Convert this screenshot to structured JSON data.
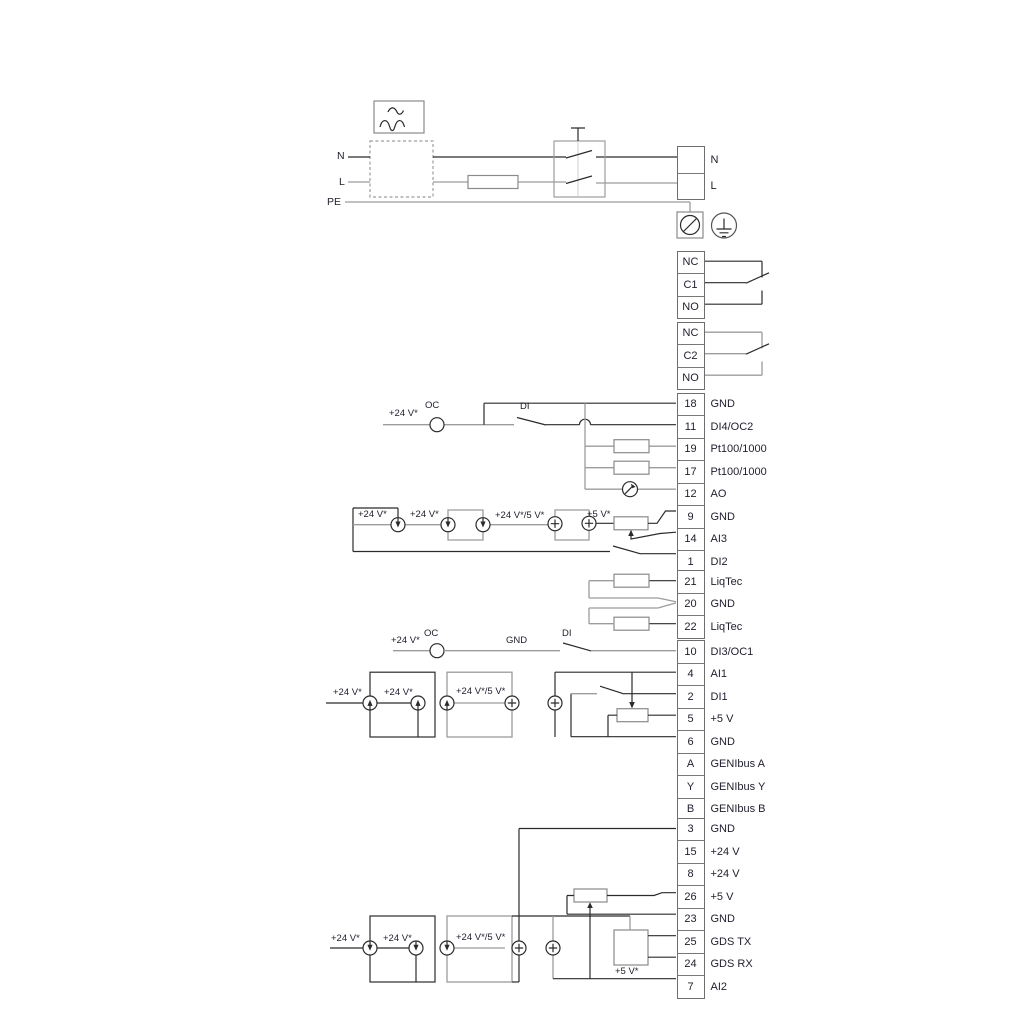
{
  "colors": {
    "wire_dark": "#2b2b2b",
    "wire_grey": "#9c9c9c",
    "symbol_grey": "#8a8a8a",
    "text": "#1e1e2d",
    "background": "#ffffff"
  },
  "power": {
    "n": "N",
    "l": "L",
    "pe": "PE"
  },
  "annotations": {
    "plus24": "+24 V*",
    "plus24_5": "+24 V*/5 V*",
    "plus5": "+5 V*",
    "oc": "OC",
    "di": "DI",
    "gnd": "GND"
  },
  "blocks": {
    "mains": {
      "rows": [
        {
          "id": "",
          "label": "N"
        },
        {
          "id": "",
          "label": "L"
        }
      ]
    },
    "relay_upper": {
      "rows": [
        {
          "id": "NC"
        },
        {
          "id": "C1"
        },
        {
          "id": "NO"
        }
      ]
    },
    "relay_lower": {
      "rows": [
        {
          "id": "NC"
        },
        {
          "id": "C2"
        },
        {
          "id": "NO"
        }
      ]
    },
    "io_top": {
      "rows": [
        {
          "id": "18",
          "label": "GND"
        },
        {
          "id": "11",
          "label": "DI4/OC2"
        },
        {
          "id": "19",
          "label": "Pt100/1000"
        },
        {
          "id": "17",
          "label": "Pt100/1000"
        },
        {
          "id": "12",
          "label": "AO"
        },
        {
          "id": "9",
          "label": "GND"
        },
        {
          "id": "14",
          "label": "AI3"
        },
        {
          "id": "1",
          "label": "DI2"
        }
      ]
    },
    "liqtec": {
      "rows": [
        {
          "id": "21",
          "label": "LiqTec"
        },
        {
          "id": "20",
          "label": "GND"
        },
        {
          "id": "22",
          "label": "LiqTec"
        }
      ]
    },
    "io_mid": {
      "rows": [
        {
          "id": "10",
          "label": "DI3/OC1"
        },
        {
          "id": "4",
          "label": "AI1"
        },
        {
          "id": "2",
          "label": "DI1"
        },
        {
          "id": "5",
          "label": "+5 V"
        },
        {
          "id": "6",
          "label": "GND"
        },
        {
          "id": "A",
          "label": "GENIbus A"
        },
        {
          "id": "Y",
          "label": "GENIbus Y"
        },
        {
          "id": "B",
          "label": "GENIbus B"
        }
      ]
    },
    "io_bottom": {
      "rows": [
        {
          "id": "3",
          "label": "GND"
        },
        {
          "id": "15",
          "label": "+24 V"
        },
        {
          "id": "8",
          "label": "+24 V"
        },
        {
          "id": "26",
          "label": "+5 V"
        },
        {
          "id": "23",
          "label": "GND"
        },
        {
          "id": "25",
          "label": "GDS TX"
        },
        {
          "id": "24",
          "label": "GDS RX"
        },
        {
          "id": "7",
          "label": "AI2"
        }
      ]
    }
  }
}
